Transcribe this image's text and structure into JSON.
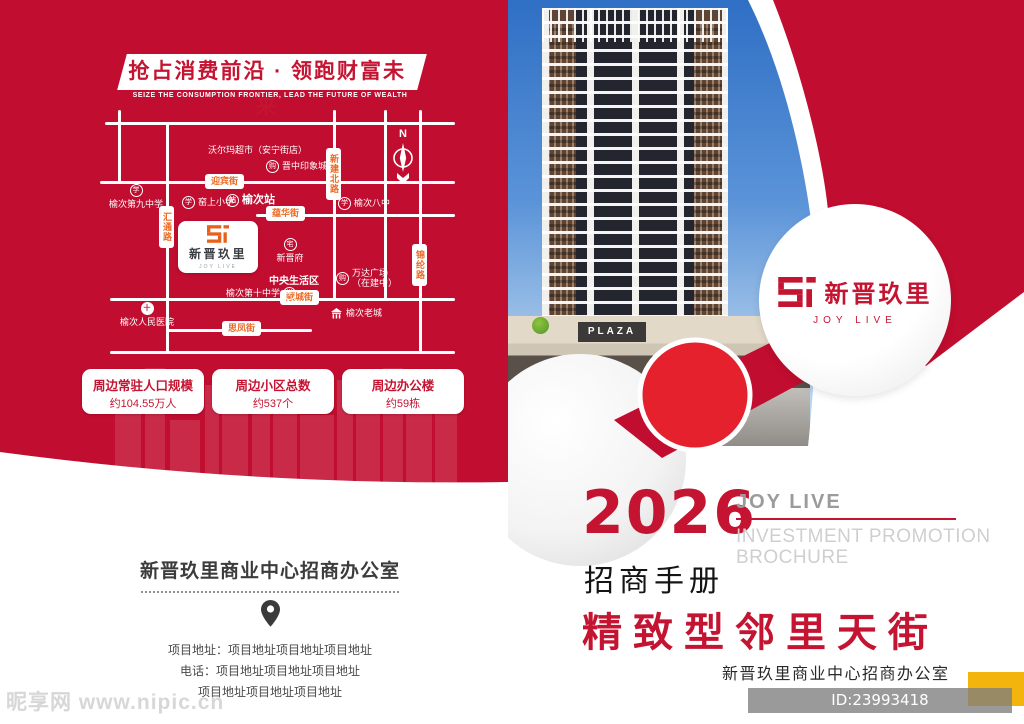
{
  "colors": {
    "page_red": "#c10d2f",
    "accent_orange": "#ed6a24",
    "title_red": "#c41432",
    "bright_red": "#e5212e",
    "yellow": "#f3b40d"
  },
  "left_page": {
    "banner": {
      "title": "抢占消费前沿 · 领跑财富未来",
      "subtitle": "SEIZE THE CONSUMPTION FRONTIER, LEAD THE FUTURE OF WEALTH"
    },
    "map": {
      "compass": "N",
      "logo_card": {
        "brand": "新晋玖里",
        "tagline": "JOY LIVE"
      },
      "streets": [
        "迎宾街",
        "蕴华街",
        "顺城街",
        "思凤街",
        "汇通路",
        "新建北路",
        "锦纶路"
      ],
      "pois": [
        {
          "icon": "",
          "label": "沃尔玛超市（安宁街店）"
        },
        {
          "icon": "购",
          "label": "晋中印象城"
        },
        {
          "icon": "学",
          "label": "榆次第九中学"
        },
        {
          "icon": "学",
          "label": "窑上小学"
        },
        {
          "icon": "站",
          "label": "榆次站"
        },
        {
          "icon": "学",
          "label": "榆次八中"
        },
        {
          "icon": "宅",
          "label": "新晋府"
        },
        {
          "icon": "",
          "label": "中央生活区"
        },
        {
          "icon": "购",
          "label": "万达广场",
          "label2": "（在建中）"
        },
        {
          "icon": "学",
          "label": "榆次第十中学"
        },
        {
          "icon": "十",
          "label": "榆次人民医院"
        },
        {
          "icon": "",
          "label": "榆次老城"
        }
      ]
    },
    "stats": [
      {
        "label": "周边常驻人口规模",
        "value": "约104.55万人"
      },
      {
        "label": "周边小区总数",
        "value": "约537个"
      },
      {
        "label": "周边办公楼",
        "value": "约59栋"
      }
    ],
    "office": {
      "title": "新晋玖里商业中心招商办公室",
      "address_line1": "项目地址：项目地址项目地址项目地址",
      "address_line2": "电话：项目地址项目地址项目地址",
      "address_line3": "项目地址项目地址项目地址"
    },
    "site_watermark": "昵享网 www.nipic.cn"
  },
  "right_page": {
    "photo": {
      "plaza_sign": "PLAZA"
    },
    "logo_circle": {
      "brand": "新晋玖里",
      "tagline": "JOY LIVE"
    },
    "year": "2026",
    "brand_en": "JOY LIVE",
    "brochure_en_line1": "INVESTMENT PROMOTION",
    "brochure_en_line2": "BROCHURE",
    "brochure_cn": "招商手册",
    "main_title": "精致型邻里天街",
    "office_name": "新晋玖里商业中心招商办公室",
    "id_watermark": "ID:23993418 NO:20260326222023394121"
  }
}
